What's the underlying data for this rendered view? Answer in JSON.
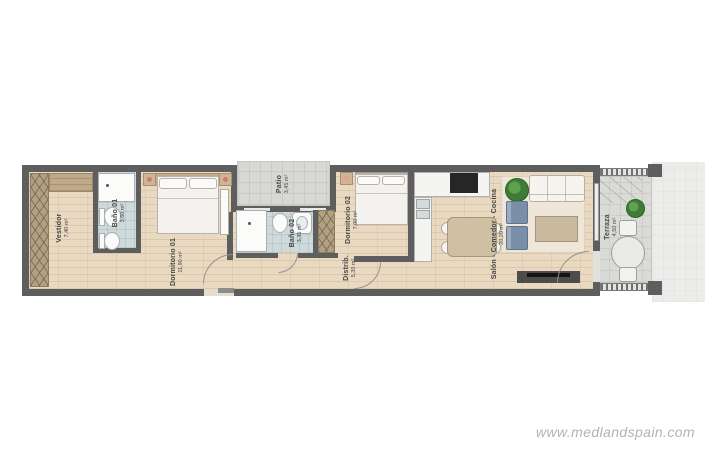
{
  "page": {
    "watermark": "www.medlandspain.com"
  },
  "colors": {
    "wall": "#5e5e5e",
    "wood": "#e9d9c1",
    "bath": "#cdd9da",
    "tile": "#d7d7d3",
    "terrace-tile": "#dadad6",
    "hatch": "#b2a083",
    "rug": "#eee7d9",
    "accent": "#7b90a8",
    "counter": "#f4f4f2",
    "cooktop": "#262626",
    "label-text": "#474747"
  },
  "rooms": [
    {
      "id": "vestidor",
      "name": "Vestidor",
      "area": "7,40 m²"
    },
    {
      "id": "bano-01",
      "name": "Baño 01",
      "area": "3,60 m²"
    },
    {
      "id": "dormitorio-01",
      "name": "Dormitorio 01",
      "area": "11,90 m²"
    },
    {
      "id": "patio",
      "name": "Patio",
      "area": "3,45 m²"
    },
    {
      "id": "bano-02",
      "name": "Baño 02",
      "area": "3,35 m²"
    },
    {
      "id": "distribuidor",
      "name": "Distrib.",
      "area": "5,35 m²"
    },
    {
      "id": "dormitorio-02",
      "name": "Dormitorio 02",
      "area": "7,00 m²"
    },
    {
      "id": "salon",
      "name": "Salón - Comedor - Cocina",
      "area": "20,20 m²"
    },
    {
      "id": "terraza",
      "name": "Terraza",
      "area": "4,50 m²"
    }
  ]
}
